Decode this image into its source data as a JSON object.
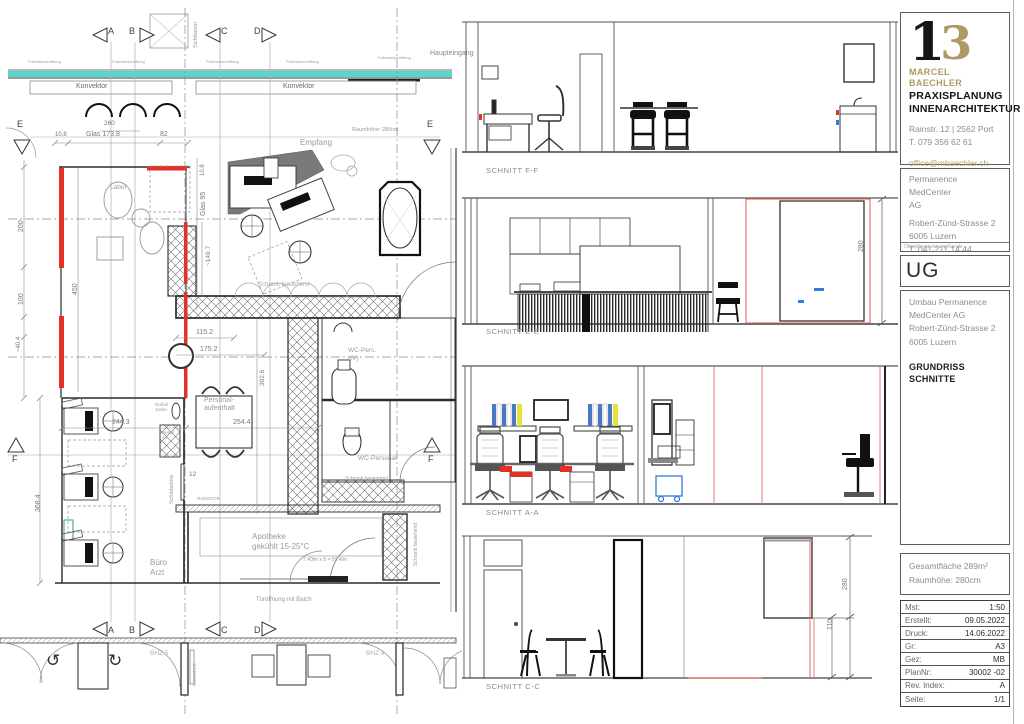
{
  "colors": {
    "teal": "#56d6cd",
    "red": "#e33225",
    "gold": "#b09a63",
    "blue": "#2f7de0",
    "yellow": "#e8e23e"
  },
  "floor_plan": {
    "markers": {
      "a": "A",
      "b": "B",
      "c": "C",
      "d": "D",
      "e": "E",
      "f": "F"
    },
    "labels": {
      "konvektor_left": "Konvektor",
      "konvektor_right": "Konvektor",
      "sichtbeton": "Sichtbeton",
      "haupteingang": "Haupteingang",
      "raumhoehe": "Raumhöhe: 280cm",
      "empfang": "Empfang",
      "labor": "Labor",
      "schrank_empfang": "Schrank bestehend",
      "personalaufenthalt": "Personal-\naufenthalt",
      "buero_arzt": "Büro\nArzt",
      "apotheke": "Apotheke\ngekühlt 15-25°C",
      "apotheke_dim": "7.40lm x 8 = 59.4lm",
      "tueroeffnung": "Türöffnung mit Batch",
      "wc_pers": "WC-Pers.\n(IV)",
      "wc_personal": "WC-Personal",
      "schrank_wc": "Schrank bestehend",
      "schrank_apotheke": "Schrank bestehend",
      "schiebetuere": "Schiebetüre",
      "radiator": "RADIATOR",
      "bhz5": "BHZ 5",
      "bhz4": "BHZ 4",
      "notfall": "Notfall\nJacke",
      "regal": "Regal\nA4",
      "folien": "Folienbeschriftung"
    },
    "dims": {
      "d108": "10.8",
      "glas1738": "Glas 173.8",
      "d82": "82",
      "d260": "260",
      "d200": "200",
      "d100": "100",
      "d404": "~40.4",
      "d450": "450",
      "d3684": "368.4",
      "glas95_108": "10.8",
      "glas95": "Glas 95",
      "d1497": "~149.7",
      "d3926": "392.6",
      "d1152": "115.2",
      "d1752": "175.2",
      "d2443": "244.3",
      "d2544": "254.4",
      "d12": "12"
    }
  },
  "sections": {
    "ff": {
      "label": "SCHNITT F-F"
    },
    "ee": {
      "label": "SCHNITT E-E",
      "dim280": "280"
    },
    "aa": {
      "label": "SCHNITT A-A"
    },
    "cc": {
      "label": "SCHNITT C-C",
      "dim280": "280",
      "dim110": "110"
    }
  },
  "title_block": {
    "logo": {
      "mark_black": "1",
      "mark_gold": "3",
      "name": "MARCEL BAECHLER",
      "line1": "PRAXISPLANUNG",
      "line2": "INNENARCHITEKTUR",
      "address": "Rainstr. 12 | 2562 Port",
      "phone": "T. 079 356 62 61",
      "email": "office@mbaechler.ch",
      "web": "marcelbaechler.ch"
    },
    "client": {
      "name": "Permanence MedCenter\nAG",
      "street": "Robert-Zünd-Strasse 2",
      "city": "6005 Luzern",
      "phone": "T: 041 211 14 44",
      "caption": "Objektbezeichnung/Kunde"
    },
    "level": "UG",
    "project": {
      "address": "Umbau Permanence\nMedCenter AG\nRobert-Zünd-Strasse 2\n6005 Luzern",
      "title": "GRUNDRISS\nSCHNITTE"
    },
    "area": {
      "line1": "Gesamtfläche 289m²",
      "line2": "Raumhöhe: 280cm"
    },
    "info_table": {
      "rows": [
        {
          "label": "Mst:",
          "value": "1:50"
        },
        {
          "label": "Erstellt:",
          "value": "09.05.2022"
        },
        {
          "label": "Druck:",
          "value": "14.06.2022"
        },
        {
          "label": "Gr:",
          "value": "A3"
        },
        {
          "label": "Gez:",
          "value": "MB"
        },
        {
          "label": "PlanNr:",
          "value": "30002 -02"
        },
        {
          "label": "Rev. Index:",
          "value": "A"
        },
        {
          "label": "Seite:",
          "value": "1/1"
        }
      ]
    }
  }
}
